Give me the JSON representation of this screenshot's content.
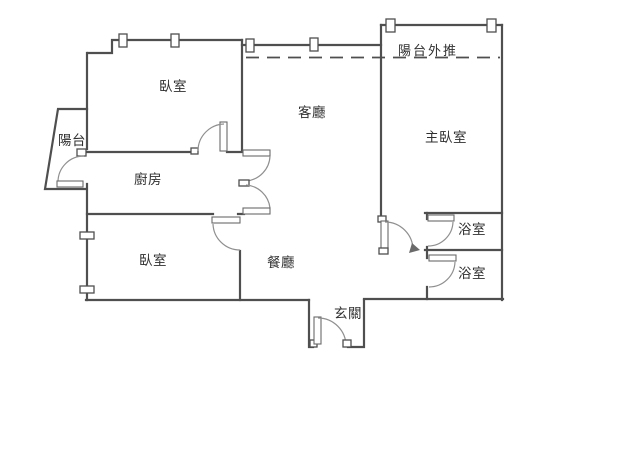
{
  "plan": {
    "type": "apartment-floor-plan",
    "rooms": {
      "bedroom1": "臥室",
      "living_room": "客廳",
      "master_bedroom": "主臥室",
      "balcony_extension": "陽台外推",
      "balcony": "陽台",
      "kitchen": "廚房",
      "bedroom2": "臥室",
      "dining_room": "餐廳",
      "entry": "玄關",
      "bathroom1": "浴室",
      "bathroom2": "浴室"
    }
  },
  "colors": {
    "wall": "#4f4f4f",
    "arc": "#8f8f8f",
    "text": "#2f2f2f",
    "background": "#ffffff"
  }
}
